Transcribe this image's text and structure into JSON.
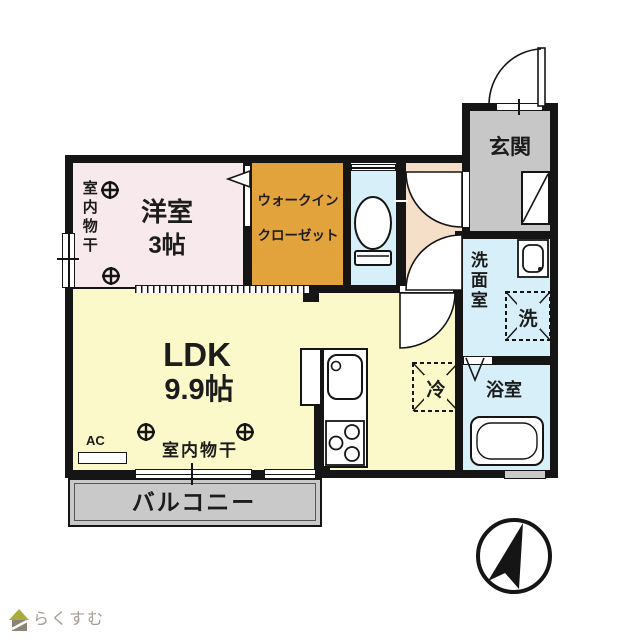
{
  "plan": {
    "rooms": {
      "western": {
        "name": "洋室",
        "size": "3帖",
        "color": "#f8e9ec"
      },
      "wic": {
        "line1": "ウォークイン",
        "line2": "クローゼット",
        "color": "#e2a33c"
      },
      "toilet": {
        "color": "#d7eff8"
      },
      "hall": {
        "color": "#f6dfc8"
      },
      "ldk": {
        "name": "LDK",
        "size": "9.9帖",
        "color": "#fbf9ca"
      },
      "entrance": {
        "name": "玄関",
        "color": "#c7c7c7"
      },
      "washroom": {
        "name": "洗面室",
        "color": "#d7eff8"
      },
      "bathroom": {
        "name": "浴室",
        "color": "#d7eff8"
      },
      "balcony": {
        "name": "バルコニー",
        "color": "#c9c9c9"
      }
    },
    "labels": {
      "indoor_drying_vertical": "室内物干",
      "indoor_drying_horizontal": "室内物干",
      "ac": "AC",
      "washer_symbol": "洗",
      "fridge_symbol": "冷"
    },
    "wall_color": "#151515"
  },
  "footer": {
    "logo_text": "らくすむ"
  }
}
